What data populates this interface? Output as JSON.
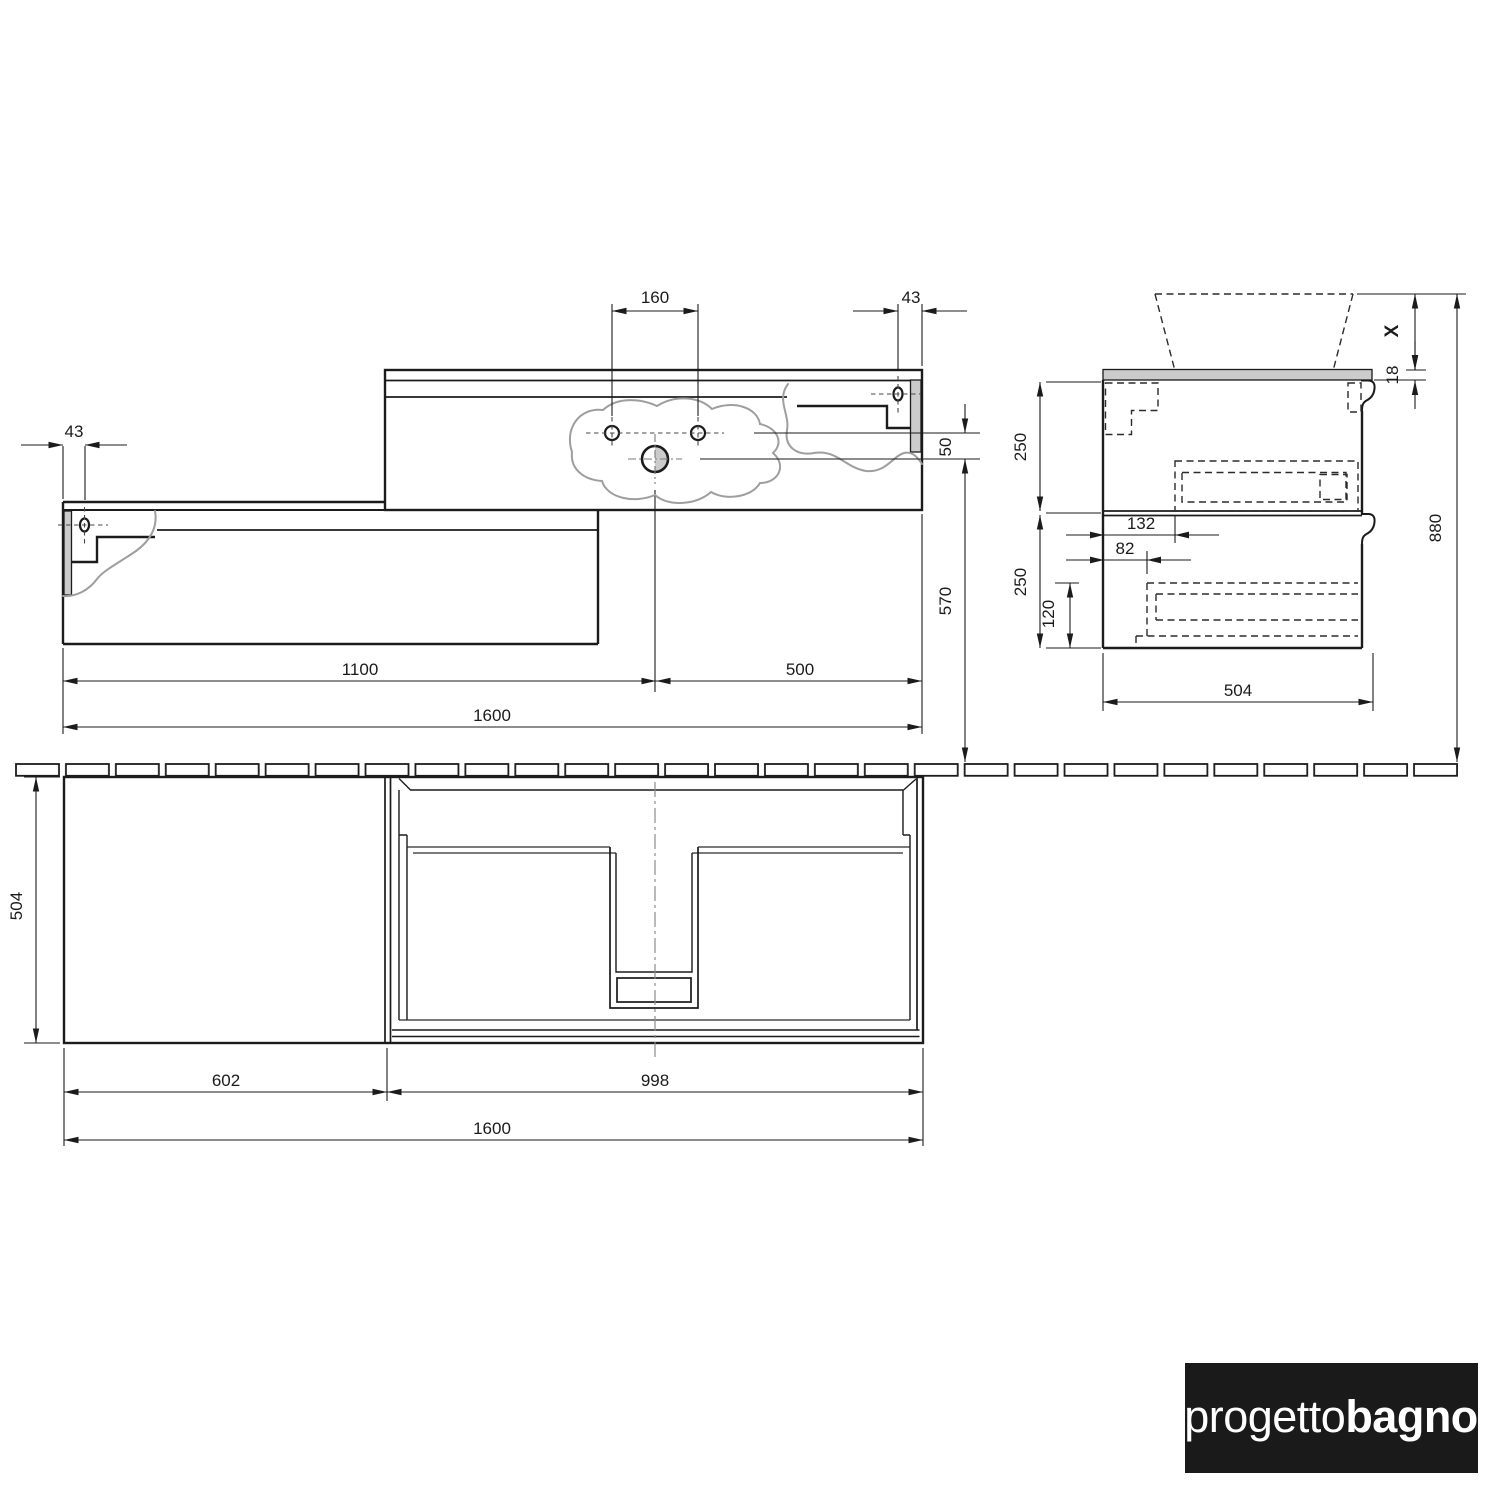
{
  "views": {
    "front": {
      "w160": "160",
      "w43r": "43",
      "w43l": "43",
      "h50": "50",
      "h570": "570",
      "w1100": "1100",
      "w500": "500",
      "w1600": "1600"
    },
    "side": {
      "x": "X",
      "t18": "18",
      "h250a": "250",
      "h250b": "250",
      "w132": "132",
      "w82": "82",
      "h120": "120",
      "d504": "504",
      "h880": "880"
    },
    "plan": {
      "d504": "504",
      "w602": "602",
      "w998": "998",
      "w1600": "1600"
    }
  },
  "logo": {
    "light": "progetto",
    "bold": "bagno"
  },
  "colors": {
    "line": "#1b1b1b",
    "break_line": "#9e9e9e",
    "section_fill": "#cbcbcb",
    "logo_bg": "#1a1a1a",
    "logo_fg": "#ffffff",
    "background": "#ffffff"
  }
}
